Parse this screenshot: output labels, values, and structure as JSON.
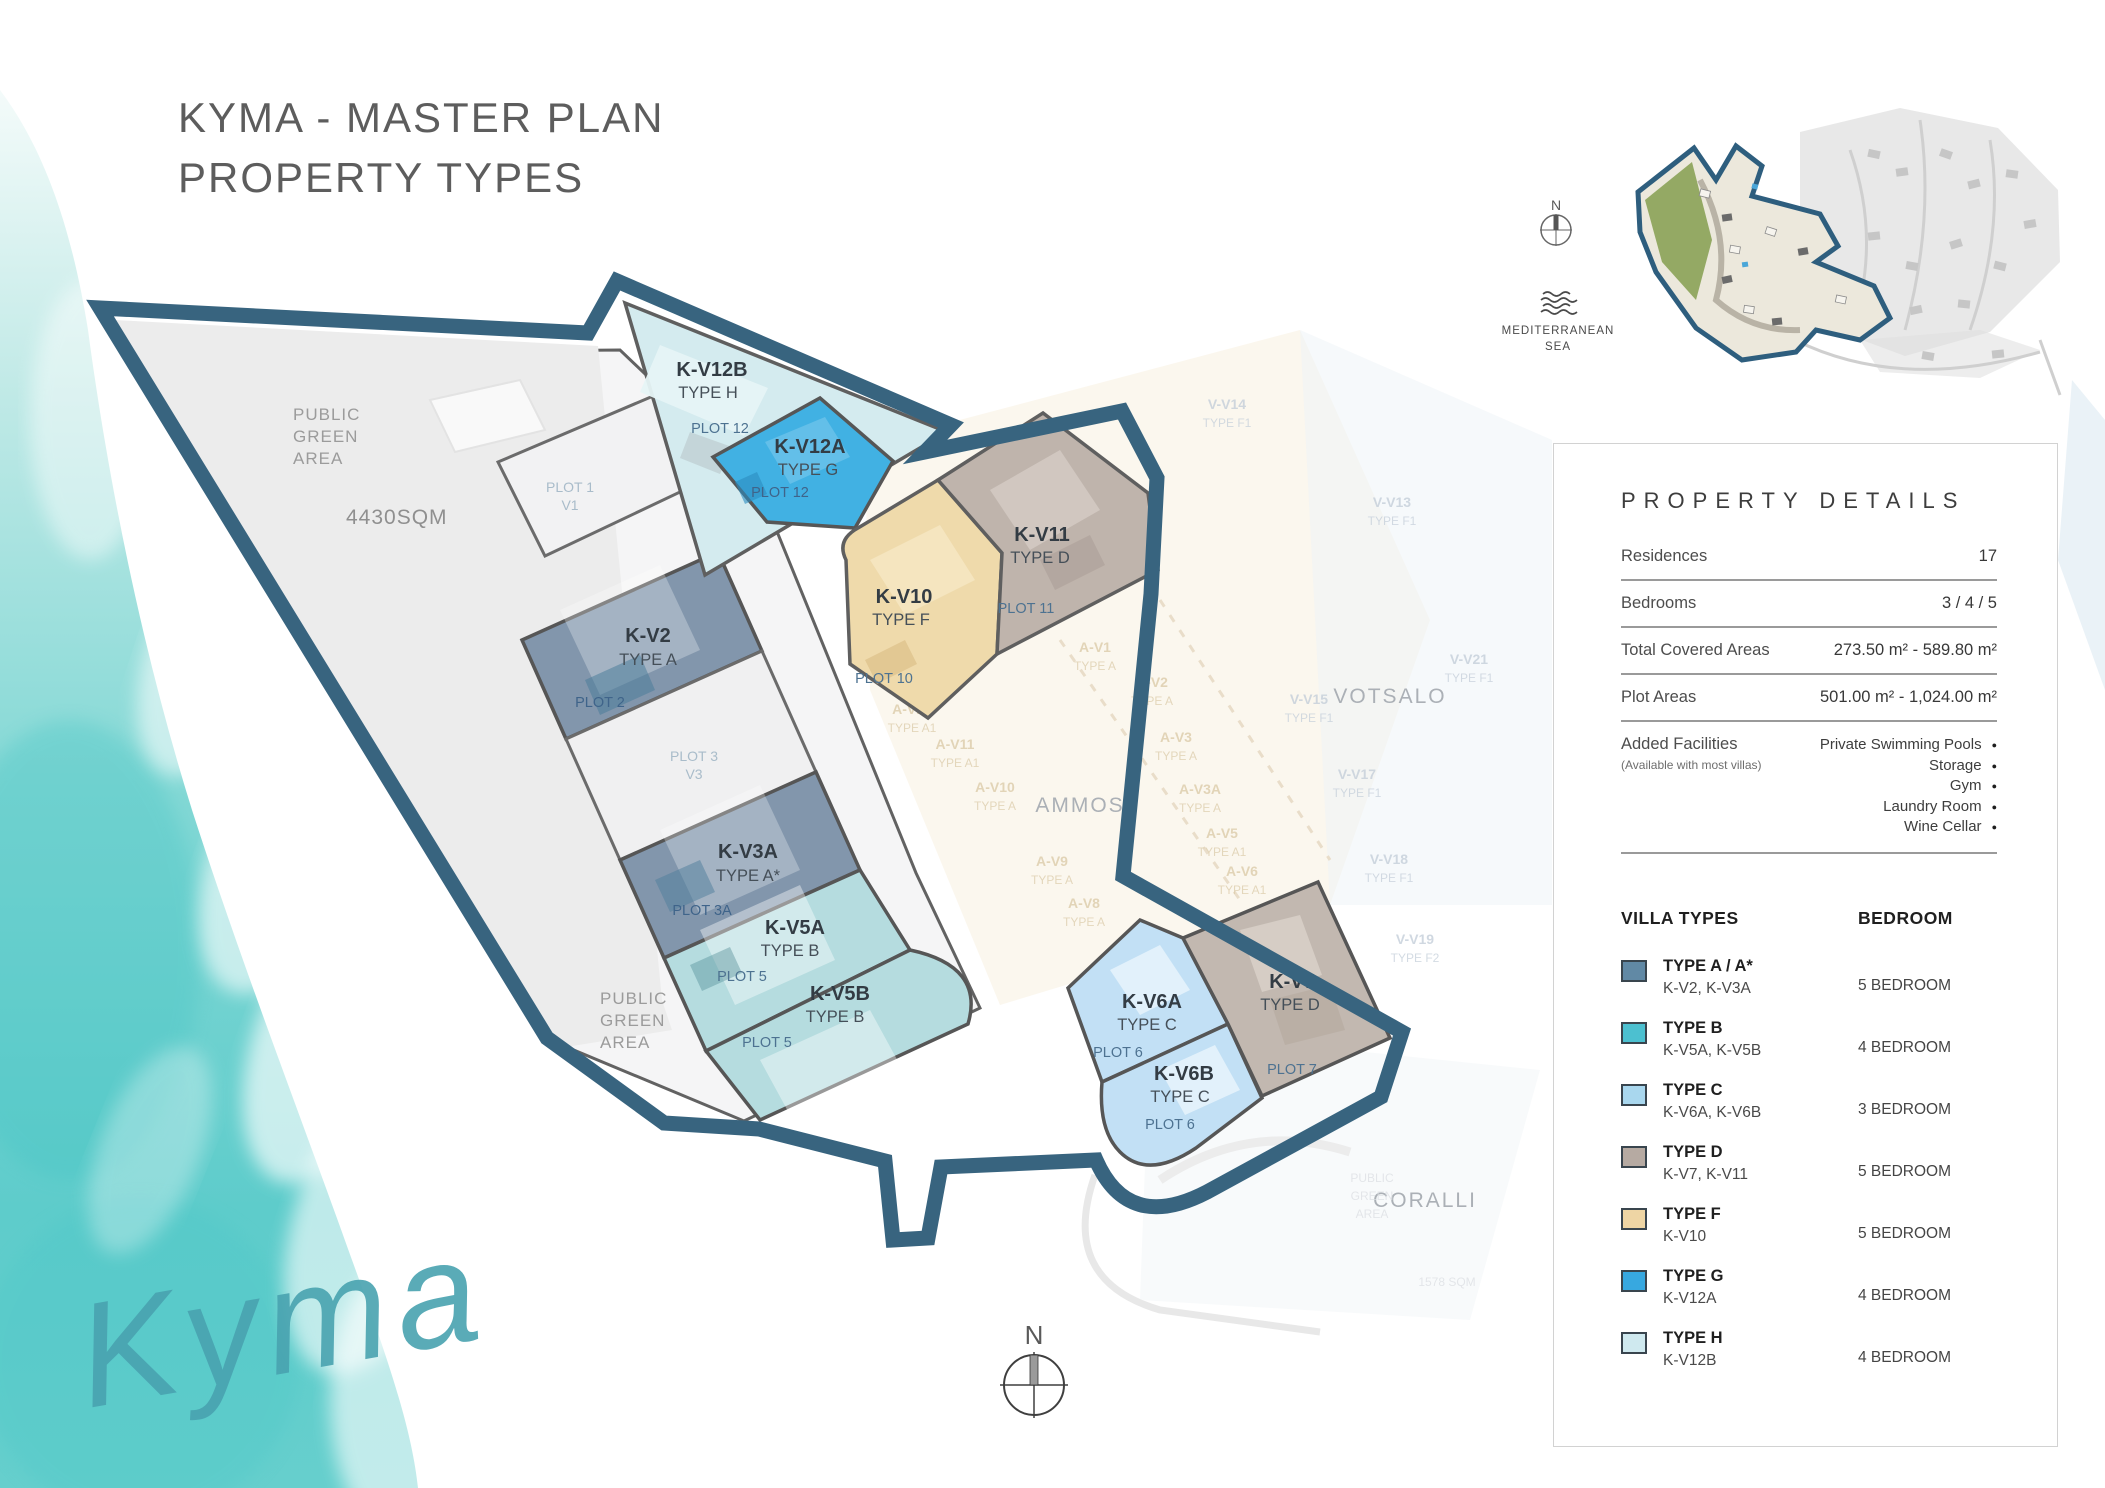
{
  "header": {
    "title_line1": "KYMA - MASTER PLAN",
    "title_line2": "PROPERTY TYPES"
  },
  "logo": {
    "script": "Kyma"
  },
  "compass": {
    "north": "N"
  },
  "mini_map": {
    "north": "N",
    "sea_line1": "MEDITERRANEAN",
    "sea_line2": "SEA"
  },
  "areas": {
    "public_green_top": {
      "lines": [
        "PUBLIC",
        "GREEN",
        "AREA"
      ],
      "size": "4430SQM"
    },
    "public_green_bottom": {
      "lines": [
        "PUBLIC",
        "GREEN",
        "AREA"
      ]
    },
    "ammos": "AMMOS",
    "votsalo": "VOTSALO",
    "coralli": "CORALLI",
    "sqm_faint": "1578 SQM",
    "public_green_faint": [
      "PUBLIC",
      "GREEN",
      "AREA"
    ]
  },
  "plots": {
    "kv12b": {
      "name": "K-V12B",
      "type": "TYPE H",
      "plot": "PLOT 12",
      "color": "#d4ebef"
    },
    "kv12a": {
      "name": "K-V12A",
      "type": "TYPE G",
      "plot": "PLOT 12",
      "color": "#41b1e3"
    },
    "kv11": {
      "name": "K-V11",
      "type": "TYPE D",
      "plot": "PLOT 11",
      "color": "#bfb4ac"
    },
    "kv10": {
      "name": "K-V10",
      "type": "TYPE F",
      "plot": "PLOT 10",
      "color": "#efdaab"
    },
    "kv2": {
      "name": "K-V2",
      "type": "TYPE A",
      "plot": "PLOT 2",
      "color": "#8296ac"
    },
    "kv3a": {
      "name": "K-V3A",
      "type": "TYPE A*",
      "plot": "PLOT 3A",
      "color": "#8296ac"
    },
    "kv5a": {
      "name": "K-V5A",
      "type": "TYPE B",
      "plot": "PLOT 5",
      "color": "#b5dcdf"
    },
    "kv5b": {
      "name": "K-V5B",
      "type": "TYPE B",
      "plot": "PLOT 5",
      "color": "#b5dcdf"
    },
    "kv6a": {
      "name": "K-V6A",
      "type": "TYPE C",
      "plot": "PLOT 6",
      "color": "#c2e0f5"
    },
    "kv6b": {
      "name": "K-V6B",
      "type": "TYPE C",
      "plot": "PLOT 6",
      "color": "#c2e0f5"
    },
    "kv7": {
      "name": "K-V7",
      "type": "TYPE D",
      "plot": "PLOT 7",
      "color": "#c2b8b0"
    },
    "plot1": {
      "plot": "PLOT 1",
      "unit": "V1",
      "color": "#f2f2f3"
    },
    "plot3": {
      "plot": "PLOT 3",
      "unit": "V3",
      "color": "#f0f0f1"
    }
  },
  "faint": [
    {
      "text": "A-V1",
      "sub": "TYPE A"
    },
    {
      "text": "A-V2",
      "sub": "TYPE A"
    },
    {
      "text": "A-V3",
      "sub": "TYPE A"
    },
    {
      "text": "A-V3A",
      "sub": "TYPE A"
    },
    {
      "text": "A-V5",
      "sub": "TYPE A1"
    },
    {
      "text": "A-V6",
      "sub": "TYPE A1"
    },
    {
      "text": "A-V9",
      "sub": "TYPE A"
    },
    {
      "text": "A-V8",
      "sub": "TYPE A"
    },
    {
      "text": "A-V10",
      "sub": "TYPE A"
    },
    {
      "text": "A-V11",
      "sub": "TYPE A1"
    },
    {
      "text": "A-V12",
      "sub": "TYPE A1"
    },
    {
      "text": "V-V13",
      "sub": "TYPE F1"
    },
    {
      "text": "V-V14",
      "sub": "TYPE F1"
    },
    {
      "text": "V-V15",
      "sub": "TYPE F1"
    },
    {
      "text": "V-V17",
      "sub": "TYPE F1"
    },
    {
      "text": "V-V18",
      "sub": "TYPE F1"
    },
    {
      "text": "V-V19",
      "sub": "TYPE F2"
    },
    {
      "text": "V-V21",
      "sub": "TYPE F1"
    }
  ],
  "panel": {
    "heading": "PROPERTY DETAILS",
    "rows": [
      {
        "label": "Residences",
        "value": "17"
      },
      {
        "label": "Bedrooms",
        "value": "3 / 4 / 5"
      },
      {
        "label": "Total Covered Areas",
        "value": "273.50 m² - 589.80 m²"
      },
      {
        "label": "Plot Areas",
        "value": "501.00 m² - 1,024.00 m²"
      }
    ],
    "facilities": {
      "label": "Added Facilities",
      "note": "(Available with most villas)",
      "bullet": "●",
      "items": [
        "Private Swimming Pools",
        "Storage",
        "Gym",
        "Laundry Room",
        "Wine Cellar"
      ]
    },
    "legend": {
      "heading_left": "VILLA TYPES",
      "heading_right": "BEDROOM",
      "rows": [
        {
          "type": "TYPE A / A*",
          "villas": "K-V2, K-V3A",
          "bedrooms": "5 BEDROOM",
          "color": "#6189a5"
        },
        {
          "type": "TYPE B",
          "villas": "K-V5A, K-V5B",
          "bedrooms": "4 BEDROOM",
          "color": "#4cc0d0"
        },
        {
          "type": "TYPE C",
          "villas": "K-V6A, K-V6B",
          "bedrooms": "3 BEDROOM",
          "color": "#a9d7ee"
        },
        {
          "type": "TYPE D",
          "villas": "K-V7, K-V11",
          "bedrooms": "5 BEDROOM",
          "color": "#b6aaa2"
        },
        {
          "type": "TYPE F",
          "villas": "K-V10",
          "bedrooms": "5 BEDROOM",
          "color": "#eed5a4"
        },
        {
          "type": "TYPE G",
          "villas": "K-V12A",
          "bedrooms": "4 BEDROOM",
          "color": "#37a8e0"
        },
        {
          "type": "TYPE H",
          "villas": "K-V12B",
          "bedrooms": "4 BEDROOM",
          "color": "#cfe9ef"
        }
      ]
    }
  }
}
